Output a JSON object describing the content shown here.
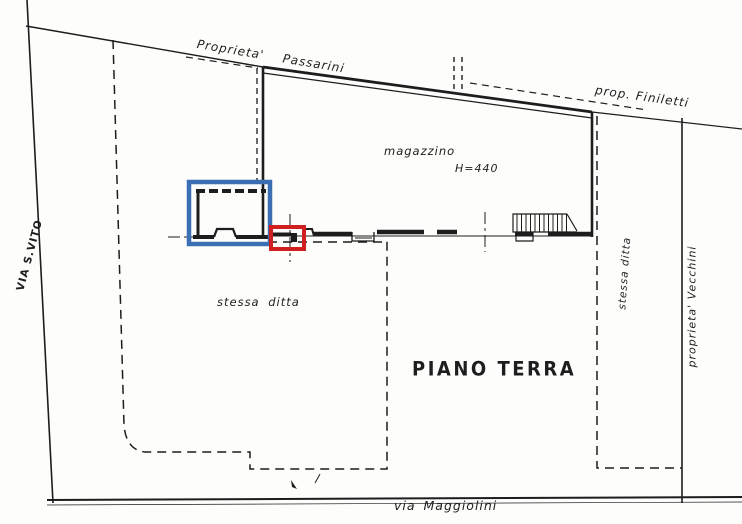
{
  "document": {
    "kind": "scanned cadastral floor plan",
    "plan_title": "PIANO TERRA"
  },
  "labels": {
    "passarini": "Proprieta' Passarini",
    "finiletti": "prop. Finiletti",
    "magazzino": "magazzino",
    "height": "H=440",
    "stessa_ditta_left": "stessa ditta",
    "stessa_ditta_right": "stessa ditta",
    "vecchini": "proprieta' Vecchini",
    "via_s_vito": "VIA S.VITO",
    "piano_terra": "PIANO TERRA",
    "via_maggiolini": "via Maggiolini"
  },
  "annotations": {
    "blue_box_color": "#3b6fb3",
    "red_box_color": "#cf1f1f"
  },
  "colors": {
    "ink": "#1d1d1d",
    "paper": "#fdfdfc"
  }
}
